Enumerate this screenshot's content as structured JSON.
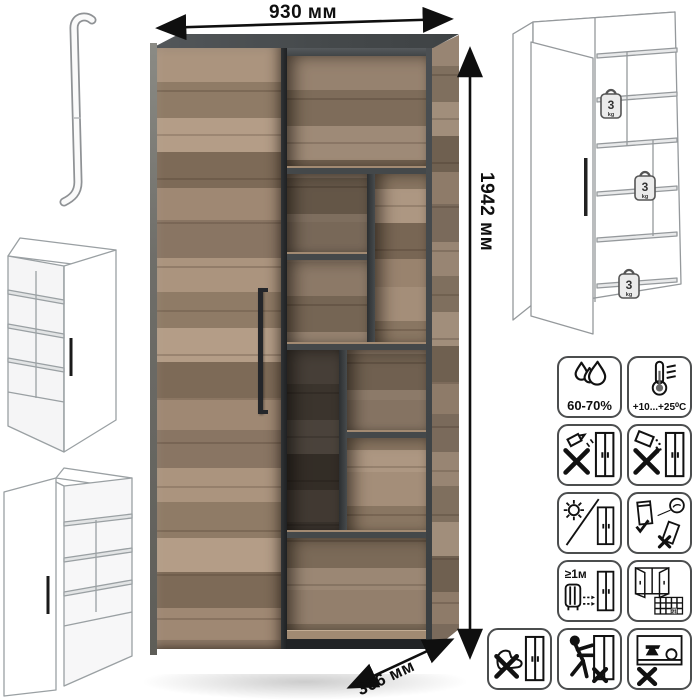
{
  "dimensions": {
    "width": "930 мм",
    "height": "1942 мм",
    "depth": "366 мм"
  },
  "shelf_load": {
    "weights": [
      {
        "value": "3",
        "unit": "kg"
      },
      {
        "value": "3",
        "unit": "kg"
      },
      {
        "value": "3",
        "unit": "kg"
      }
    ]
  },
  "care_icons": [
    {
      "name": "humidity-range",
      "label": "60-70%"
    },
    {
      "name": "temperature-range",
      "label": "+10...+25⁰C"
    },
    {
      "name": "no-liquids"
    },
    {
      "name": "no-abrasive-powder"
    },
    {
      "name": "no-direct-sunlight"
    },
    {
      "name": "secure-anti-tip-check"
    },
    {
      "name": "min-distance-from-heat",
      "label": "≥1м"
    },
    {
      "name": "ventilate-room-days",
      "label": "21"
    },
    {
      "name": "no-standing-on-base"
    },
    {
      "name": "no-pushing-when-loaded"
    },
    {
      "name": "no-overloading-shelves"
    }
  ],
  "colors": {
    "wood_light": "#b49d87",
    "wood_mid": "#9a8470",
    "wood_dark": "#7d6a57",
    "carcass_gray": "#45484a",
    "shadow_dark": "#26282a",
    "line_gray": "#95999c",
    "text_black": "#0f0f0f"
  }
}
